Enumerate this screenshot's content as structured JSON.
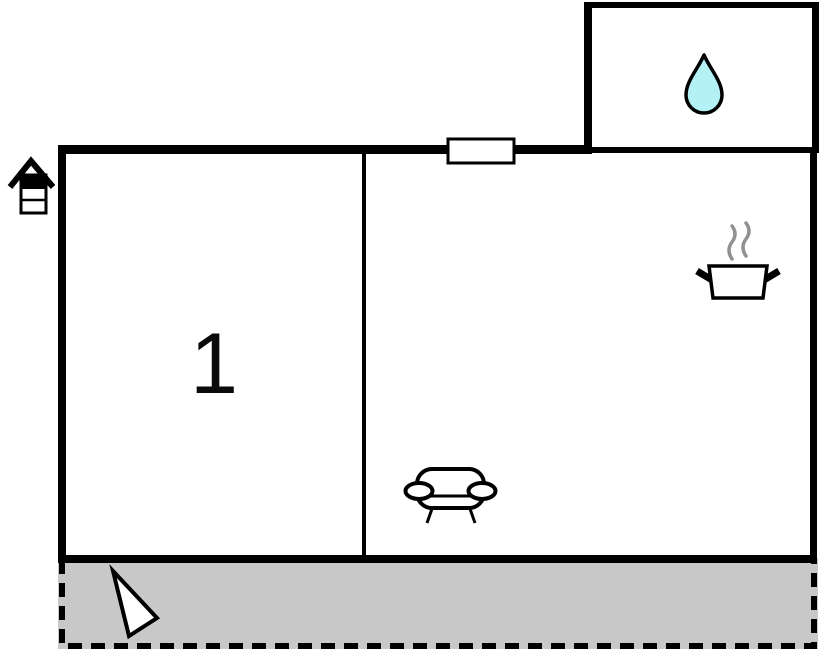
{
  "type": "floor-plan",
  "rooms": {
    "room1": {
      "label": "1"
    },
    "bathroom": {
      "feature": "water-drop"
    },
    "living_kitchen": {
      "features": [
        "cooking-pot",
        "sofa"
      ]
    },
    "terrace": {
      "feature": "north-arrow"
    }
  },
  "exterior": {
    "feature": "house-marker"
  },
  "colors": {
    "wall": "#000000",
    "background": "#ffffff",
    "water_drop": "#b3f1f5",
    "terrace_fill": "#c8c8c8",
    "steam": "#919191",
    "furniture_fill": "#ffffff"
  }
}
